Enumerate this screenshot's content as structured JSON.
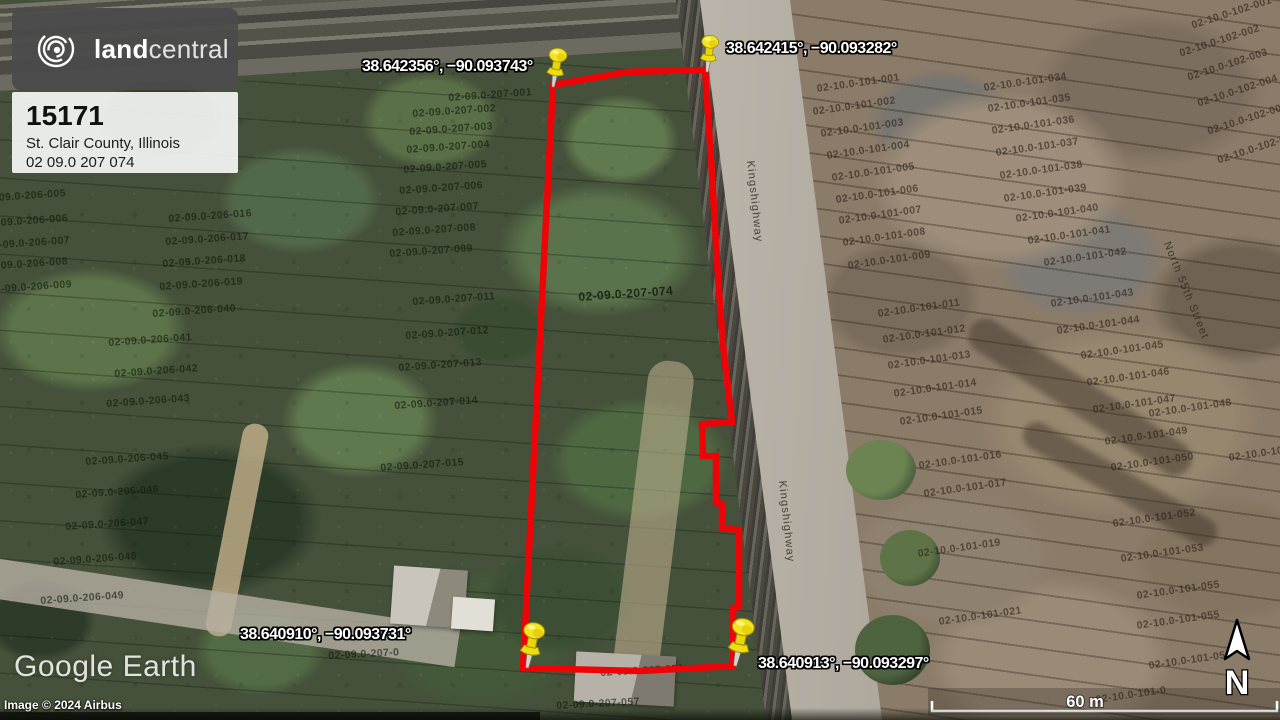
{
  "branding": {
    "logo_text_bold": "land",
    "logo_text_light": "central"
  },
  "listing": {
    "property_id": "15171",
    "county": "St. Clair County, Illinois",
    "apn": "02 09.0 207 074"
  },
  "colors": {
    "parcel_outline": "#ee0407",
    "pin_yellow": "#f2e000",
    "coordinate_text": "#ffffff",
    "brand_card_bg": "#4b4b4b"
  },
  "parcel_outline": {
    "points": [
      [
        553,
        85
      ],
      [
        627,
        72
      ],
      [
        705,
        70
      ],
      [
        711,
        158
      ],
      [
        717,
        262
      ],
      [
        723,
        345
      ],
      [
        732,
        422
      ],
      [
        702,
        424
      ],
      [
        703,
        456
      ],
      [
        716,
        456
      ],
      [
        716,
        503
      ],
      [
        722,
        504
      ],
      [
        722,
        528
      ],
      [
        739,
        530
      ],
      [
        739,
        607
      ],
      [
        733,
        608
      ],
      [
        733,
        666
      ],
      [
        640,
        671
      ],
      [
        523,
        668
      ]
    ]
  },
  "pins": [
    {
      "label": "38.642356°, −90.093743°",
      "tip_x": 553,
      "tip_y": 87,
      "rot": 9,
      "scale": 0.85,
      "label_x": 362,
      "label_y": 58
    },
    {
      "label": "38.642415°, −90.093282°",
      "tip_x": 707,
      "tip_y": 72,
      "rot": 6,
      "scale": 0.8,
      "label_x": 726,
      "label_y": 40
    },
    {
      "label": "38.640910°, −90.093731°",
      "tip_x": 527,
      "tip_y": 668,
      "rot": 11,
      "scale": 1.0,
      "label_x": 240,
      "label_y": 626
    },
    {
      "label": "38.640913°, −90.093297°",
      "tip_x": 735,
      "tip_y": 666,
      "rot": 12,
      "scale": 1.05,
      "label_x": 758,
      "label_y": 655
    }
  ],
  "watermark": {
    "logo": "Google Earth",
    "attribution": "Image © 2024 Airbus"
  },
  "scale_bar": {
    "label": "60 m"
  },
  "compass": {
    "label": "N"
  },
  "map_labels": [
    {
      "t": "02-09.0-207-001",
      "x": 448,
      "y": 92,
      "r": -4,
      "c": "g"
    },
    {
      "t": "02-09.0-207-002",
      "x": 412,
      "y": 108,
      "r": -4,
      "c": "g"
    },
    {
      "t": "02-09.0-207-003",
      "x": 409,
      "y": 126,
      "r": -4,
      "c": "g"
    },
    {
      "t": "02-09.0-207-004",
      "x": 406,
      "y": 144,
      "r": -4,
      "c": "g"
    },
    {
      "t": "02-09.0-207-005",
      "x": 403,
      "y": 164,
      "r": -4,
      "c": "g"
    },
    {
      "t": "02-09.0-207-006",
      "x": 399,
      "y": 185,
      "r": -4,
      "c": "g"
    },
    {
      "t": "02-09.0-207-007",
      "x": 395,
      "y": 206,
      "r": -4,
      "c": "g"
    },
    {
      "t": "02-09.0-207-008",
      "x": 392,
      "y": 227,
      "r": -4,
      "c": "g"
    },
    {
      "t": "02-09.0-207-009",
      "x": 389,
      "y": 248,
      "r": -4,
      "c": "g"
    },
    {
      "t": "02-09.0-207-011",
      "x": 412,
      "y": 296,
      "r": -4,
      "c": "g"
    },
    {
      "t": "02-09.0-207-012",
      "x": 405,
      "y": 330,
      "r": -4,
      "c": "g"
    },
    {
      "t": "02-09.0-207-013",
      "x": 398,
      "y": 362,
      "r": -4,
      "c": "g"
    },
    {
      "t": "02-09.0-207-014",
      "x": 394,
      "y": 400,
      "r": -4,
      "c": "g"
    },
    {
      "t": "02-09.0-207-015",
      "x": 380,
      "y": 462,
      "r": -4,
      "c": "g"
    },
    {
      "t": "02-09.0-206-005",
      "x": -18,
      "y": 193,
      "r": -4,
      "c": "g"
    },
    {
      "t": "02-09.0-206-006",
      "x": -16,
      "y": 218,
      "r": -4,
      "c": "g"
    },
    {
      "t": "02-09.0-206-007",
      "x": -14,
      "y": 240,
      "r": -4,
      "c": "g"
    },
    {
      "t": "02-09.0-206-008",
      "x": -16,
      "y": 261,
      "r": -4,
      "c": "g"
    },
    {
      "t": "02-09.0-206-009",
      "x": -12,
      "y": 284,
      "r": -4,
      "c": "g"
    },
    {
      "t": "02-09.0-206-016",
      "x": 168,
      "y": 213,
      "r": -4,
      "c": "g"
    },
    {
      "t": "02-09.0-206-017",
      "x": 165,
      "y": 236,
      "r": -4,
      "c": "g"
    },
    {
      "t": "02-09.0-206-018",
      "x": 162,
      "y": 258,
      "r": -4,
      "c": "g"
    },
    {
      "t": "02-09.0-206-019",
      "x": 159,
      "y": 281,
      "r": -4,
      "c": "g"
    },
    {
      "t": "02-09.0-206-040",
      "x": 152,
      "y": 308,
      "r": -4,
      "c": "g"
    },
    {
      "t": "02-09.0-206-041",
      "x": 108,
      "y": 337,
      "r": -4,
      "c": "g"
    },
    {
      "t": "02-09.0-206-042",
      "x": 114,
      "y": 368,
      "r": -4,
      "c": "g"
    },
    {
      "t": "02-09.0-206-043",
      "x": 106,
      "y": 398,
      "r": -4,
      "c": "g"
    },
    {
      "t": "02-09.0-206-045",
      "x": 85,
      "y": 456,
      "r": -4,
      "c": "g"
    },
    {
      "t": "02-09.0-206-046",
      "x": 75,
      "y": 489,
      "r": -4,
      "c": "g"
    },
    {
      "t": "02-09.0-206-047",
      "x": 65,
      "y": 521,
      "r": -4,
      "c": "g"
    },
    {
      "t": "02-09.0-206-048",
      "x": 53,
      "y": 556,
      "r": -4,
      "c": "g"
    },
    {
      "t": "02-09.0-206-049",
      "x": 40,
      "y": 595,
      "r": -4,
      "c": "g"
    },
    {
      "t": "02-09.0-207-056",
      "x": 600,
      "y": 667,
      "r": -3,
      "c": "g"
    },
    {
      "t": "02-09.0-207-057",
      "x": 556,
      "y": 700,
      "r": -3,
      "c": "g"
    },
    {
      "t": "02-09.0-207-0",
      "x": 328,
      "y": 650,
      "r": -3,
      "c": "g"
    },
    {
      "t": "02-09.0-207-074",
      "x": 578,
      "y": 290,
      "r": -4,
      "c": "p"
    },
    {
      "t": "02-10.0-101-001",
      "x": 816,
      "y": 83,
      "r": -8,
      "c": "b"
    },
    {
      "t": "02-10.0-101-002",
      "x": 812,
      "y": 106,
      "r": -8,
      "c": "b"
    },
    {
      "t": "02-10.0-101-003",
      "x": 820,
      "y": 128,
      "r": -8,
      "c": "b"
    },
    {
      "t": "02-10.0-101-004",
      "x": 826,
      "y": 150,
      "r": -8,
      "c": "b"
    },
    {
      "t": "02-10.0-101-005",
      "x": 831,
      "y": 172,
      "r": -8,
      "c": "b"
    },
    {
      "t": "02-10.0-101-006",
      "x": 835,
      "y": 194,
      "r": -8,
      "c": "b"
    },
    {
      "t": "02-10.0-101-007",
      "x": 838,
      "y": 215,
      "r": -8,
      "c": "b"
    },
    {
      "t": "02-10.0-101-008",
      "x": 842,
      "y": 237,
      "r": -8,
      "c": "b"
    },
    {
      "t": "02-10.0-101-009",
      "x": 847,
      "y": 260,
      "r": -8,
      "c": "b"
    },
    {
      "t": "02-10.0-101-011",
      "x": 877,
      "y": 308,
      "r": -8,
      "c": "b"
    },
    {
      "t": "02-10.0-101-012",
      "x": 882,
      "y": 334,
      "r": -8,
      "c": "b"
    },
    {
      "t": "02-10.0-101-013",
      "x": 887,
      "y": 360,
      "r": -8,
      "c": "b"
    },
    {
      "t": "02-10.0-101-014",
      "x": 893,
      "y": 388,
      "r": -8,
      "c": "b"
    },
    {
      "t": "02-10.0-101-015",
      "x": 899,
      "y": 416,
      "r": -8,
      "c": "b"
    },
    {
      "t": "02-10.0-101-016",
      "x": 918,
      "y": 460,
      "r": -8,
      "c": "b"
    },
    {
      "t": "02-10.0-101-017",
      "x": 923,
      "y": 488,
      "r": -8,
      "c": "b"
    },
    {
      "t": "02-10.0-101-019",
      "x": 917,
      "y": 548,
      "r": -8,
      "c": "b"
    },
    {
      "t": "02-10.0-101-021",
      "x": 938,
      "y": 616,
      "r": -8,
      "c": "b"
    },
    {
      "t": "02-10.0-101-034",
      "x": 983,
      "y": 82,
      "r": -8,
      "c": "b"
    },
    {
      "t": "02-10.0-101-035",
      "x": 987,
      "y": 103,
      "r": -8,
      "c": "b"
    },
    {
      "t": "02-10.0-101-036",
      "x": 991,
      "y": 125,
      "r": -8,
      "c": "b"
    },
    {
      "t": "02-10.0-101-037",
      "x": 995,
      "y": 147,
      "r": -8,
      "c": "b"
    },
    {
      "t": "02-10.0-101-038",
      "x": 999,
      "y": 170,
      "r": -8,
      "c": "b"
    },
    {
      "t": "02-10.0-101-039",
      "x": 1003,
      "y": 193,
      "r": -8,
      "c": "b"
    },
    {
      "t": "02-10.0-101-040",
      "x": 1015,
      "y": 213,
      "r": -8,
      "c": "b"
    },
    {
      "t": "02-10.0-101-041",
      "x": 1027,
      "y": 235,
      "r": -8,
      "c": "b"
    },
    {
      "t": "02-10.0-101-042",
      "x": 1043,
      "y": 257,
      "r": -8,
      "c": "b"
    },
    {
      "t": "02-10.0-101-043",
      "x": 1050,
      "y": 298,
      "r": -8,
      "c": "b"
    },
    {
      "t": "02-10.0-101-044",
      "x": 1056,
      "y": 325,
      "r": -8,
      "c": "b"
    },
    {
      "t": "02-10.0-101-045",
      "x": 1080,
      "y": 350,
      "r": -8,
      "c": "b"
    },
    {
      "t": "02-10.0-101-046",
      "x": 1086,
      "y": 377,
      "r": -8,
      "c": "b"
    },
    {
      "t": "02-10.0-101-047",
      "x": 1092,
      "y": 404,
      "r": -8,
      "c": "b"
    },
    {
      "t": "02-10.0-101-048",
      "x": 1148,
      "y": 408,
      "r": -8,
      "c": "b"
    },
    {
      "t": "02-10.0-101-049",
      "x": 1104,
      "y": 436,
      "r": -8,
      "c": "b"
    },
    {
      "t": "02-10.0-101-050",
      "x": 1110,
      "y": 462,
      "r": -8,
      "c": "b"
    },
    {
      "t": "02-10.0-101-051",
      "x": 1228,
      "y": 452,
      "r": -8,
      "c": "b"
    },
    {
      "t": "02-10.0-101-052",
      "x": 1112,
      "y": 518,
      "r": -8,
      "c": "b"
    },
    {
      "t": "02-10.0-101-053",
      "x": 1120,
      "y": 553,
      "r": -8,
      "c": "b"
    },
    {
      "t": "02-10.0-101-055",
      "x": 1136,
      "y": 590,
      "r": -8,
      "c": "b"
    },
    {
      "t": "02-10.0-101-055",
      "x": 1136,
      "y": 620,
      "r": -8,
      "c": "b"
    },
    {
      "t": "02-10.0-101-056",
      "x": 1148,
      "y": 660,
      "r": -8,
      "c": "b"
    },
    {
      "t": "02-10.0-101-0",
      "x": 1095,
      "y": 694,
      "r": -8,
      "c": "b"
    },
    {
      "t": "02-10.0-102-001",
      "x": 1190,
      "y": 20,
      "r": -18,
      "c": "b"
    },
    {
      "t": "02-10.0-102-002",
      "x": 1178,
      "y": 48,
      "r": -18,
      "c": "b"
    },
    {
      "t": "02-10.0-102-003",
      "x": 1186,
      "y": 72,
      "r": -18,
      "c": "b"
    },
    {
      "t": "02-10.0-102-004",
      "x": 1196,
      "y": 98,
      "r": -18,
      "c": "b"
    },
    {
      "t": "02-10.0-102-005",
      "x": 1206,
      "y": 126,
      "r": -18,
      "c": "b"
    },
    {
      "t": "02-10.0-102-006",
      "x": 1216,
      "y": 155,
      "r": -18,
      "c": "b"
    },
    {
      "t": "Kingshighway",
      "x": 756,
      "y": 160,
      "r": 84,
      "c": "s"
    },
    {
      "t": "Kingshighway",
      "x": 788,
      "y": 480,
      "r": 84,
      "c": "s"
    },
    {
      "t": "North 55th Street",
      "x": 1172,
      "y": 240,
      "r": 68,
      "c": "s"
    }
  ]
}
